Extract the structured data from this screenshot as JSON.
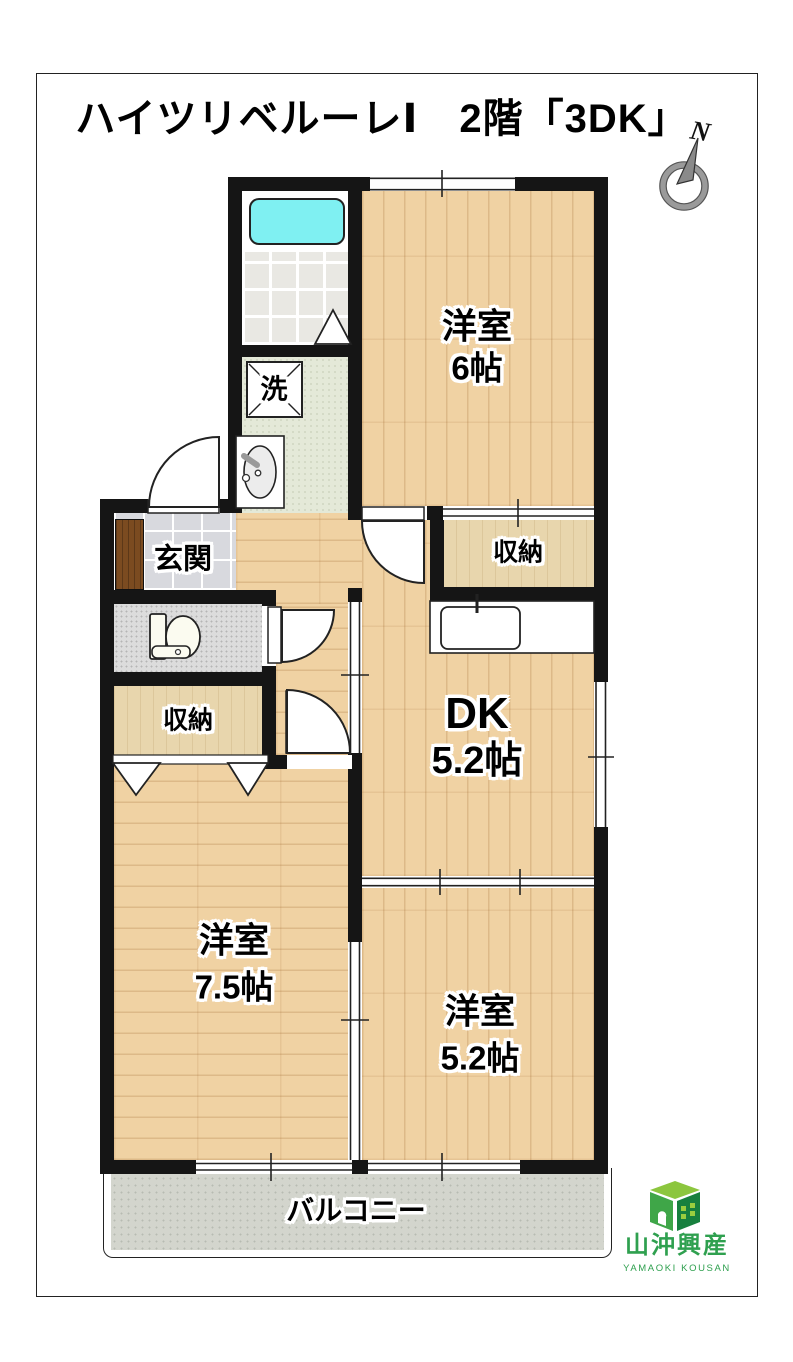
{
  "title": "ハイツリベルーレⅠ　2階「3DK」",
  "compass": {
    "label": "N"
  },
  "rooms": {
    "western6": {
      "name": "洋室",
      "size": "6帖"
    },
    "closet_upper": {
      "label": "収納"
    },
    "dk": {
      "name": "DK",
      "size": "5.2帖"
    },
    "genkan": {
      "label": "玄関"
    },
    "laundry": {
      "label": "洗"
    },
    "closet_lower": {
      "label": "収納"
    },
    "western75": {
      "name": "洋室",
      "size": "7.5帖"
    },
    "western52": {
      "name": "洋室",
      "size": "5.2帖"
    },
    "balcony": {
      "label": "バルコニー"
    }
  },
  "logo": {
    "company": "山沖興産",
    "romaji": "YAMAOKI KOUSAN"
  },
  "colors": {
    "wall": "#151515",
    "wood": "#f0d2a3",
    "bathtub": "#7ff0f2",
    "logo_green": "#2FA04F",
    "balcony_concrete": "#d3d5cd"
  }
}
